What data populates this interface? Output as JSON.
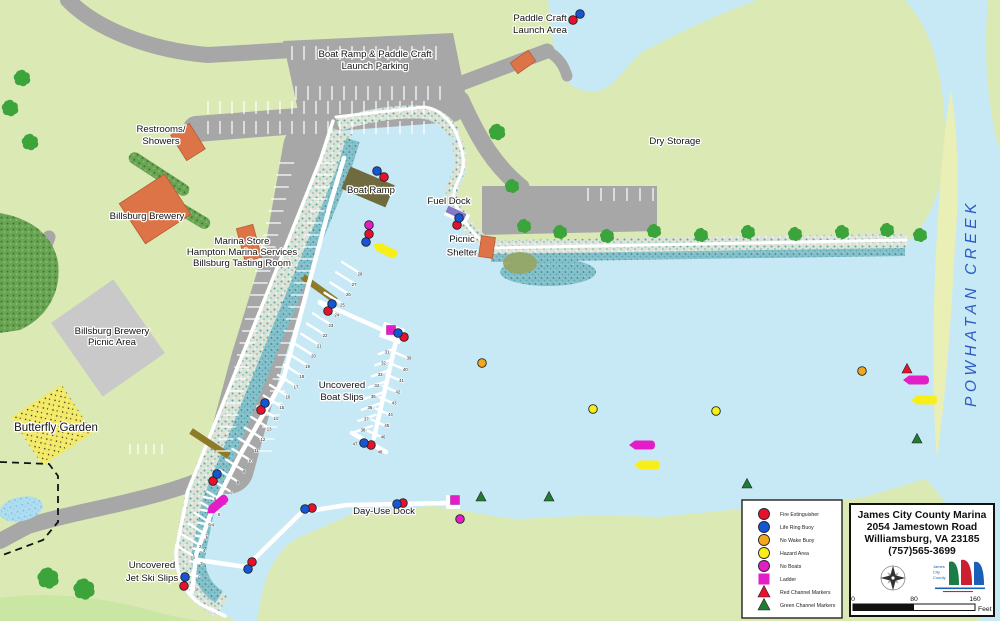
{
  "map_title": "James City County Marina",
  "creek_label": {
    "text": "POWHATAN CREEK",
    "color": "#2a5ac6",
    "x": 976,
    "y": 303
  },
  "labels": [
    {
      "id": "paddle-craft-launch-area",
      "x": 540,
      "y": 21,
      "lines": [
        "Paddle Craft",
        "Launch Area"
      ]
    },
    {
      "id": "boat-ramp-parking",
      "x": 375,
      "y": 57,
      "lines": [
        "Boat Ramp & Paddle Craft",
        "Launch Parking"
      ]
    },
    {
      "id": "restrooms-showers",
      "x": 161,
      "y": 132,
      "lines": [
        "Restrooms/",
        "Showers"
      ]
    },
    {
      "id": "billsburg-brewery",
      "x": 147,
      "y": 219,
      "lines": [
        "Billsburg Brewery"
      ]
    },
    {
      "id": "marina-store",
      "x": 242,
      "y": 244,
      "gap": 11,
      "lines": [
        "Marina Store",
        "Hampton Marina Services",
        "Billsburg Tasting Room"
      ]
    },
    {
      "id": "billsburg-picnic-area",
      "x": 112,
      "y": 334,
      "gap": 11,
      "lines": [
        "Billsburg Brewery",
        "Picnic Area"
      ]
    },
    {
      "id": "butterfly-garden",
      "x": 56,
      "y": 431,
      "size": 11.5,
      "lines": [
        "Butterfly Garden"
      ]
    },
    {
      "id": "boat-ramp",
      "x": 371,
      "y": 193,
      "lines": [
        "Boat Ramp"
      ]
    },
    {
      "id": "fuel-dock",
      "x": 449,
      "y": 204,
      "lines": [
        "Fuel Dock"
      ]
    },
    {
      "id": "picnic-shelter",
      "x": 462,
      "y": 242,
      "gap": 13.5,
      "lines": [
        "Picnic",
        "Shelter"
      ]
    },
    {
      "id": "dry-storage",
      "x": 675,
      "y": 144,
      "lines": [
        "Dry Storage"
      ]
    },
    {
      "id": "uncovered-boat-slips",
      "x": 342,
      "y": 388,
      "lines": [
        "Uncovered",
        "Boat Slips"
      ]
    },
    {
      "id": "day-use-dock",
      "x": 384,
      "y": 514,
      "lines": [
        "Day-Use Dock"
      ]
    },
    {
      "id": "uncovered-jet-ski-slips",
      "x": 152,
      "y": 568,
      "gap": 13,
      "lines": [
        "Uncovered",
        "Jet Ski Slips"
      ]
    }
  ],
  "docks": {
    "slip_rows": [
      {
        "name": "main-dock-south",
        "from": [
          194,
          557
        ],
        "to": [
          288,
          397
        ],
        "finger": [
          -18,
          -12,
          -2,
          -2
        ],
        "numbers": [
          "1",
          "2",
          "3",
          "4",
          "5",
          "6",
          "7",
          "8",
          "9",
          "10",
          "11",
          "12",
          "13",
          "14",
          "15",
          "16"
        ]
      },
      {
        "name": "main-dock-north",
        "from": [
          296,
          387
        ],
        "to": [
          360,
          274
        ],
        "finger": [
          -18,
          -12,
          -2,
          -2
        ],
        "numbers": [
          "17",
          "18",
          "19",
          "20",
          "21",
          "22",
          "23",
          "24",
          "25",
          "26",
          "27",
          "28"
        ]
      },
      {
        "name": "east-dock-west-side",
        "from": [
          387,
          352
        ],
        "to": [
          363,
          430
        ],
        "finger": [
          9,
          -4,
          -8,
          2
        ],
        "numbers": [
          "31",
          "32",
          "33",
          "34",
          "35",
          "36",
          "37",
          "38"
        ]
      },
      {
        "name": "east-dock-east-side",
        "from": [
          409,
          358
        ],
        "to": [
          383,
          437
        ],
        "finger": [
          -15,
          -6,
          1,
          1
        ],
        "numbers": [
          "39",
          "40",
          "41",
          "42",
          "43",
          "44",
          "45",
          "46"
        ]
      },
      {
        "name": "east-dock-end",
        "from": [
          355,
          444
        ],
        "to": [
          380,
          452
        ],
        "finger": [
          0,
          0,
          0,
          0
        ],
        "numbers": [
          "47",
          "48"
        ]
      },
      {
        "name": "jet-ski-dock",
        "from": [
          215,
          499
        ],
        "to": [
          196,
          589
        ],
        "finger": [
          -11,
          -2,
          -1,
          0
        ],
        "numbers": [
          "8",
          "7",
          "6",
          "5",
          "4",
          "3",
          "2",
          "1"
        ]
      }
    ]
  },
  "marker_colors": {
    "fire": "#e8112d",
    "life": "#1556d6",
    "nowake": "#f5a81c",
    "hazard": "#f8ef18",
    "noboat": "#e31ec8",
    "ladder": "#e31ec8",
    "redch": "#e8112d",
    "greench": "#1e7d32"
  },
  "markers": [
    {
      "type": "fire",
      "x": 573,
      "y": 20
    },
    {
      "type": "life",
      "x": 580,
      "y": 14
    },
    {
      "type": "fire",
      "x": 384,
      "y": 177
    },
    {
      "type": "life",
      "x": 377,
      "y": 171
    },
    {
      "type": "fire",
      "x": 457,
      "y": 225
    },
    {
      "type": "life",
      "x": 459,
      "y": 218
    },
    {
      "type": "noboat",
      "x": 369,
      "y": 225
    },
    {
      "type": "fire",
      "x": 369,
      "y": 234
    },
    {
      "type": "life",
      "x": 366,
      "y": 242
    },
    {
      "type": "fire",
      "x": 328,
      "y": 311
    },
    {
      "type": "life",
      "x": 332,
      "y": 304
    },
    {
      "type": "ladder",
      "x": 391,
      "y": 330
    },
    {
      "type": "fire",
      "x": 404,
      "y": 337
    },
    {
      "type": "life",
      "x": 398,
      "y": 333
    },
    {
      "type": "fire",
      "x": 261,
      "y": 410
    },
    {
      "type": "life",
      "x": 265,
      "y": 403
    },
    {
      "type": "fire",
      "x": 213,
      "y": 481
    },
    {
      "type": "life",
      "x": 217,
      "y": 474
    },
    {
      "type": "fire",
      "x": 371,
      "y": 445
    },
    {
      "type": "life",
      "x": 364,
      "y": 443
    },
    {
      "type": "fire",
      "x": 312,
      "y": 508
    },
    {
      "type": "life",
      "x": 305,
      "y": 509
    },
    {
      "type": "fire",
      "x": 403,
      "y": 503
    },
    {
      "type": "life",
      "x": 397,
      "y": 504
    },
    {
      "type": "fire",
      "x": 252,
      "y": 562
    },
    {
      "type": "life",
      "x": 248,
      "y": 569
    },
    {
      "type": "fire",
      "x": 184,
      "y": 586
    },
    {
      "type": "life",
      "x": 185,
      "y": 577
    },
    {
      "type": "ladder",
      "x": 455,
      "y": 500
    },
    {
      "type": "noboat",
      "x": 460,
      "y": 519
    },
    {
      "type": "nowake",
      "x": 482,
      "y": 363
    },
    {
      "type": "nowake",
      "x": 862,
      "y": 371
    },
    {
      "type": "hazard",
      "x": 593,
      "y": 409
    },
    {
      "type": "hazard",
      "x": 716,
      "y": 411
    },
    {
      "type": "redch",
      "x": 907,
      "y": 369
    },
    {
      "type": "greench",
      "x": 481,
      "y": 497
    },
    {
      "type": "greench",
      "x": 549,
      "y": 497
    },
    {
      "type": "greench",
      "x": 747,
      "y": 484
    },
    {
      "type": "greench",
      "x": 917,
      "y": 439
    },
    {
      "type": "noboat-boat",
      "x": 217,
      "y": 505,
      "rot": -40
    },
    {
      "type": "noboat-boat",
      "x": 642,
      "y": 445,
      "rot": 0
    },
    {
      "type": "noboat-boat",
      "x": 916,
      "y": 380,
      "rot": 0
    },
    {
      "type": "hazard-boat",
      "x": 385,
      "y": 250,
      "rot": 25
    },
    {
      "type": "hazard-boat",
      "x": 647,
      "y": 465,
      "rot": 0
    },
    {
      "type": "hazard-boat",
      "x": 924,
      "y": 400,
      "rot": 0
    }
  ],
  "legend": {
    "x": 742,
    "y": 500,
    "w": 100,
    "h": 118,
    "items": [
      {
        "type": "fire",
        "label": "Fire Extinguisher"
      },
      {
        "type": "life",
        "label": "Life Ring Buoy"
      },
      {
        "type": "nowake",
        "label": "No Wake Buoy"
      },
      {
        "type": "hazard",
        "label": "Hazard Area"
      },
      {
        "type": "noboat",
        "label": "No Boats"
      },
      {
        "type": "ladder",
        "label": "Ladder"
      },
      {
        "type": "redch",
        "label": "Red Channel Markers"
      },
      {
        "type": "greench",
        "label": "Green Channel Markers"
      }
    ]
  },
  "info_box": {
    "x": 850,
    "y": 504,
    "w": 144,
    "h": 112,
    "lines": [
      "James City County Marina",
      "2054 Jamestown Road",
      "Williamsburg, VA 23185",
      "(757)565-3699"
    ],
    "logo_text": "James City County",
    "compass": {
      "x": 893,
      "y": 578
    },
    "logo": {
      "x": 931,
      "y": 556
    },
    "scale": {
      "x": 853,
      "y": 604,
      "w": 122,
      "labels": [
        "0",
        "80",
        "160"
      ],
      "unit": "Feet"
    }
  }
}
